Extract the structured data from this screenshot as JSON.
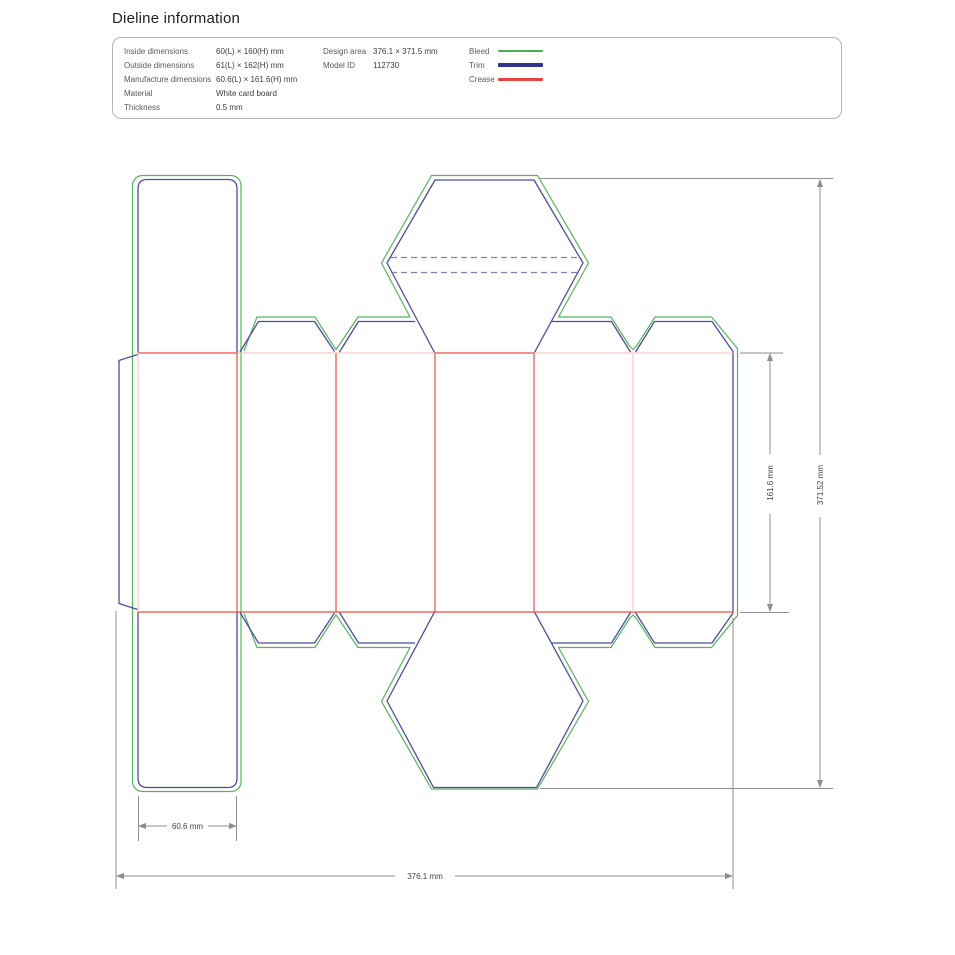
{
  "title": "Dieline information",
  "info_panel": {
    "rows": [
      {
        "label": "Inside dimensions",
        "value": "60(L) × 160(H) mm"
      },
      {
        "label": "Outside dimensions",
        "value": "61(L) × 162(H) mm"
      },
      {
        "label": "Manufacture dimensions",
        "value": "60.6(L) × 161.6(H) mm"
      },
      {
        "label": "Material",
        "value": "White card board"
      },
      {
        "label": "Thickness",
        "value": "0.5 mm"
      }
    ],
    "meta": [
      {
        "label": "Design area",
        "value": "376.1 × 371.5 mm"
      },
      {
        "label": "Model ID",
        "value": "112730"
      }
    ],
    "legend": [
      {
        "label": "Bleed",
        "color": "#45b24e"
      },
      {
        "label": "Trim",
        "color": "#32328e"
      },
      {
        "label": "Crease",
        "color": "#e8423a"
      }
    ]
  },
  "drawing": {
    "dimension_labels": {
      "panel_width": "60.6 mm",
      "total_width": "376.1 mm",
      "panel_height": "161.6 mm",
      "total_height": "371.52 mm"
    },
    "line_colors": {
      "bleed": "#54b45c",
      "trim": "#4c4c9d",
      "trim_perforation": "#7f7fb5",
      "crease": "#f04b42",
      "crease_light": "#f7bcb8",
      "dimension": "#8f8f8f"
    }
  }
}
